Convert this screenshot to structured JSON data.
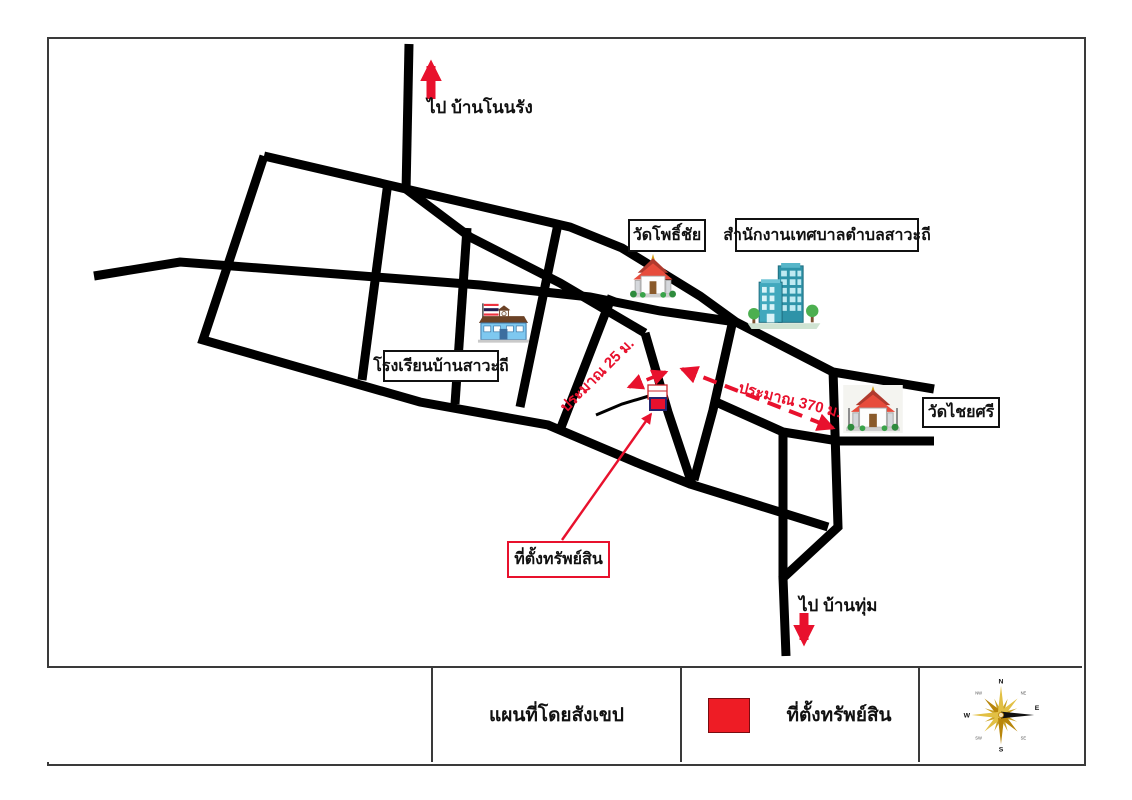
{
  "map": {
    "direction_labels": {
      "north": "ไป บ้านโนนรัง",
      "south": "ไป บ้านทุ่ม"
    },
    "landmarks": {
      "wat_pho_chai": "วัดโพธิ์ชัย",
      "municipality": "สำนักงานเทศบาลตำบลสาวะถี",
      "school": "โรงเรียนบ้านสาวะถี",
      "wat_chai_si": "วัดไชยศรี"
    },
    "property_callout": "ที่ตั้งทรัพย์สิน",
    "distances": {
      "short": "ประมาณ 25 ม.",
      "long": "ประมาณ 370 ม."
    }
  },
  "legend": {
    "map_title": "แผนที่โดยสังเขป",
    "property_label": "ที่ตั้งทรัพย์สิน",
    "swatch_color": "#ee1c25"
  },
  "compass": {
    "n": "N",
    "e": "E",
    "s": "S",
    "w": "W",
    "ne": "NE",
    "se": "SE",
    "sw": "SW",
    "nw": "NW"
  },
  "colors": {
    "road": "#000000",
    "annotation_red": "#e8112d",
    "marker_fill": "#e8112d",
    "marker_border": "#24246e"
  }
}
